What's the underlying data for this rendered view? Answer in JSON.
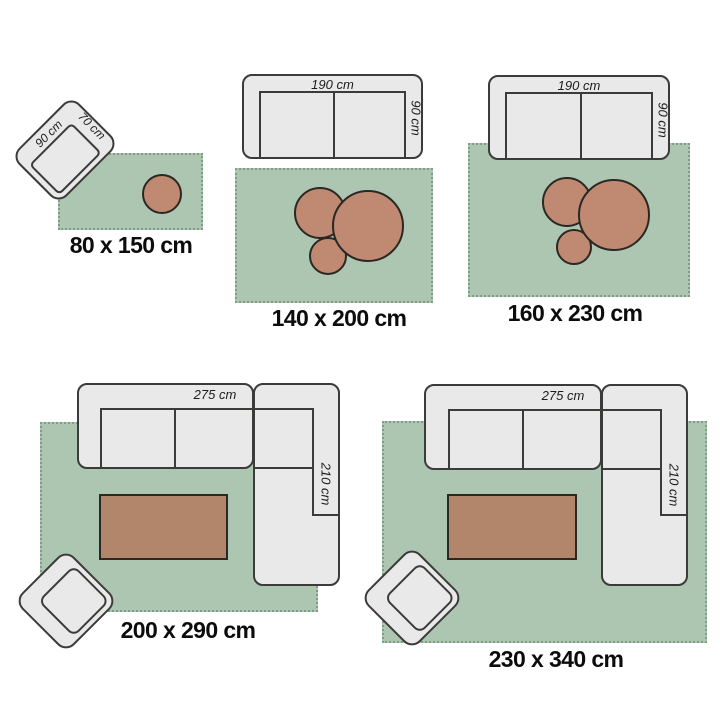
{
  "figure": {
    "kind": "rug-size-guide-diagram",
    "colors": {
      "rug_green": "#adc6b1",
      "rug_fringe": "#7f9c87",
      "pouf_brown": "#c08a72",
      "table_brown": "#b1866a",
      "furniture_gray": "#e9e9e9",
      "outline_dark": "#3b3b39",
      "background": "#ffffff"
    },
    "groups": [
      {
        "size_label": "80 x 150 cm",
        "furniture_labels": {
          "width": "90 cm",
          "depth": "70 cm"
        }
      },
      {
        "size_label": "140 x 200 cm",
        "furniture_labels": {
          "width": "190 cm",
          "depth": "90 cm"
        }
      },
      {
        "size_label": "160 x 230 cm",
        "furniture_labels": {
          "width": "190 cm",
          "depth": "90 cm"
        }
      },
      {
        "size_label": "200 x 290 cm",
        "furniture_labels": {
          "width": "275 cm",
          "depth": "210 cm"
        }
      },
      {
        "size_label": "230 x 340 cm",
        "furniture_labels": {
          "width": "275 cm",
          "depth": "210 cm"
        }
      }
    ]
  }
}
